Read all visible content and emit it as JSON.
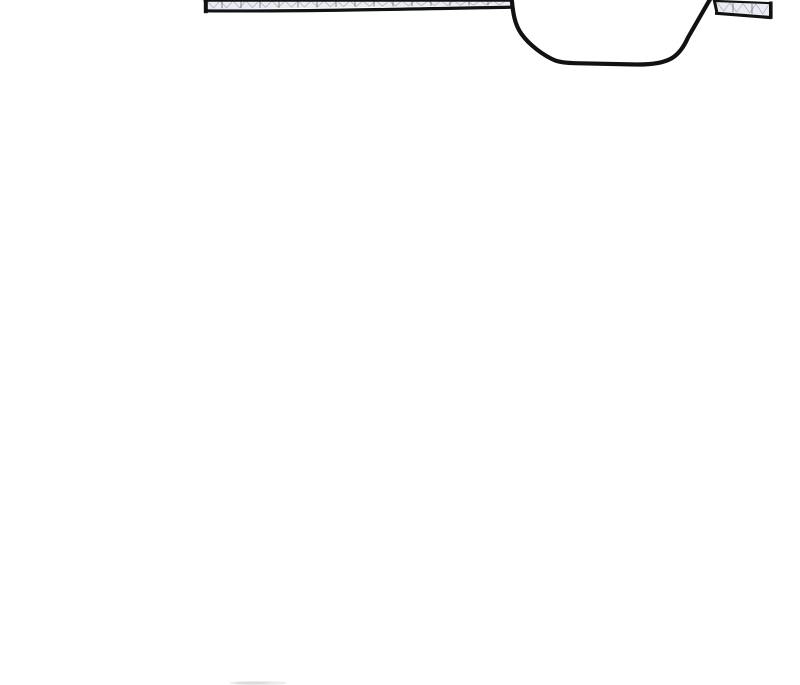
{
  "page": {
    "kind": "comic-panel-crop",
    "visible_text": ""
  },
  "colors": {
    "page_bg": "#ffffff",
    "ink": "#121212",
    "beam_fill": "#eaecf2",
    "hatch": "#a9afbd",
    "hatch_dark": "#474e5c",
    "smudge": "#d6d8dc",
    "smudge_dark": "#cdcfd4"
  },
  "artwork": {
    "elements": [
      "ceiling-beam-left",
      "lamp-shade",
      "ceiling-beam-right",
      "bottom-smudge"
    ]
  }
}
